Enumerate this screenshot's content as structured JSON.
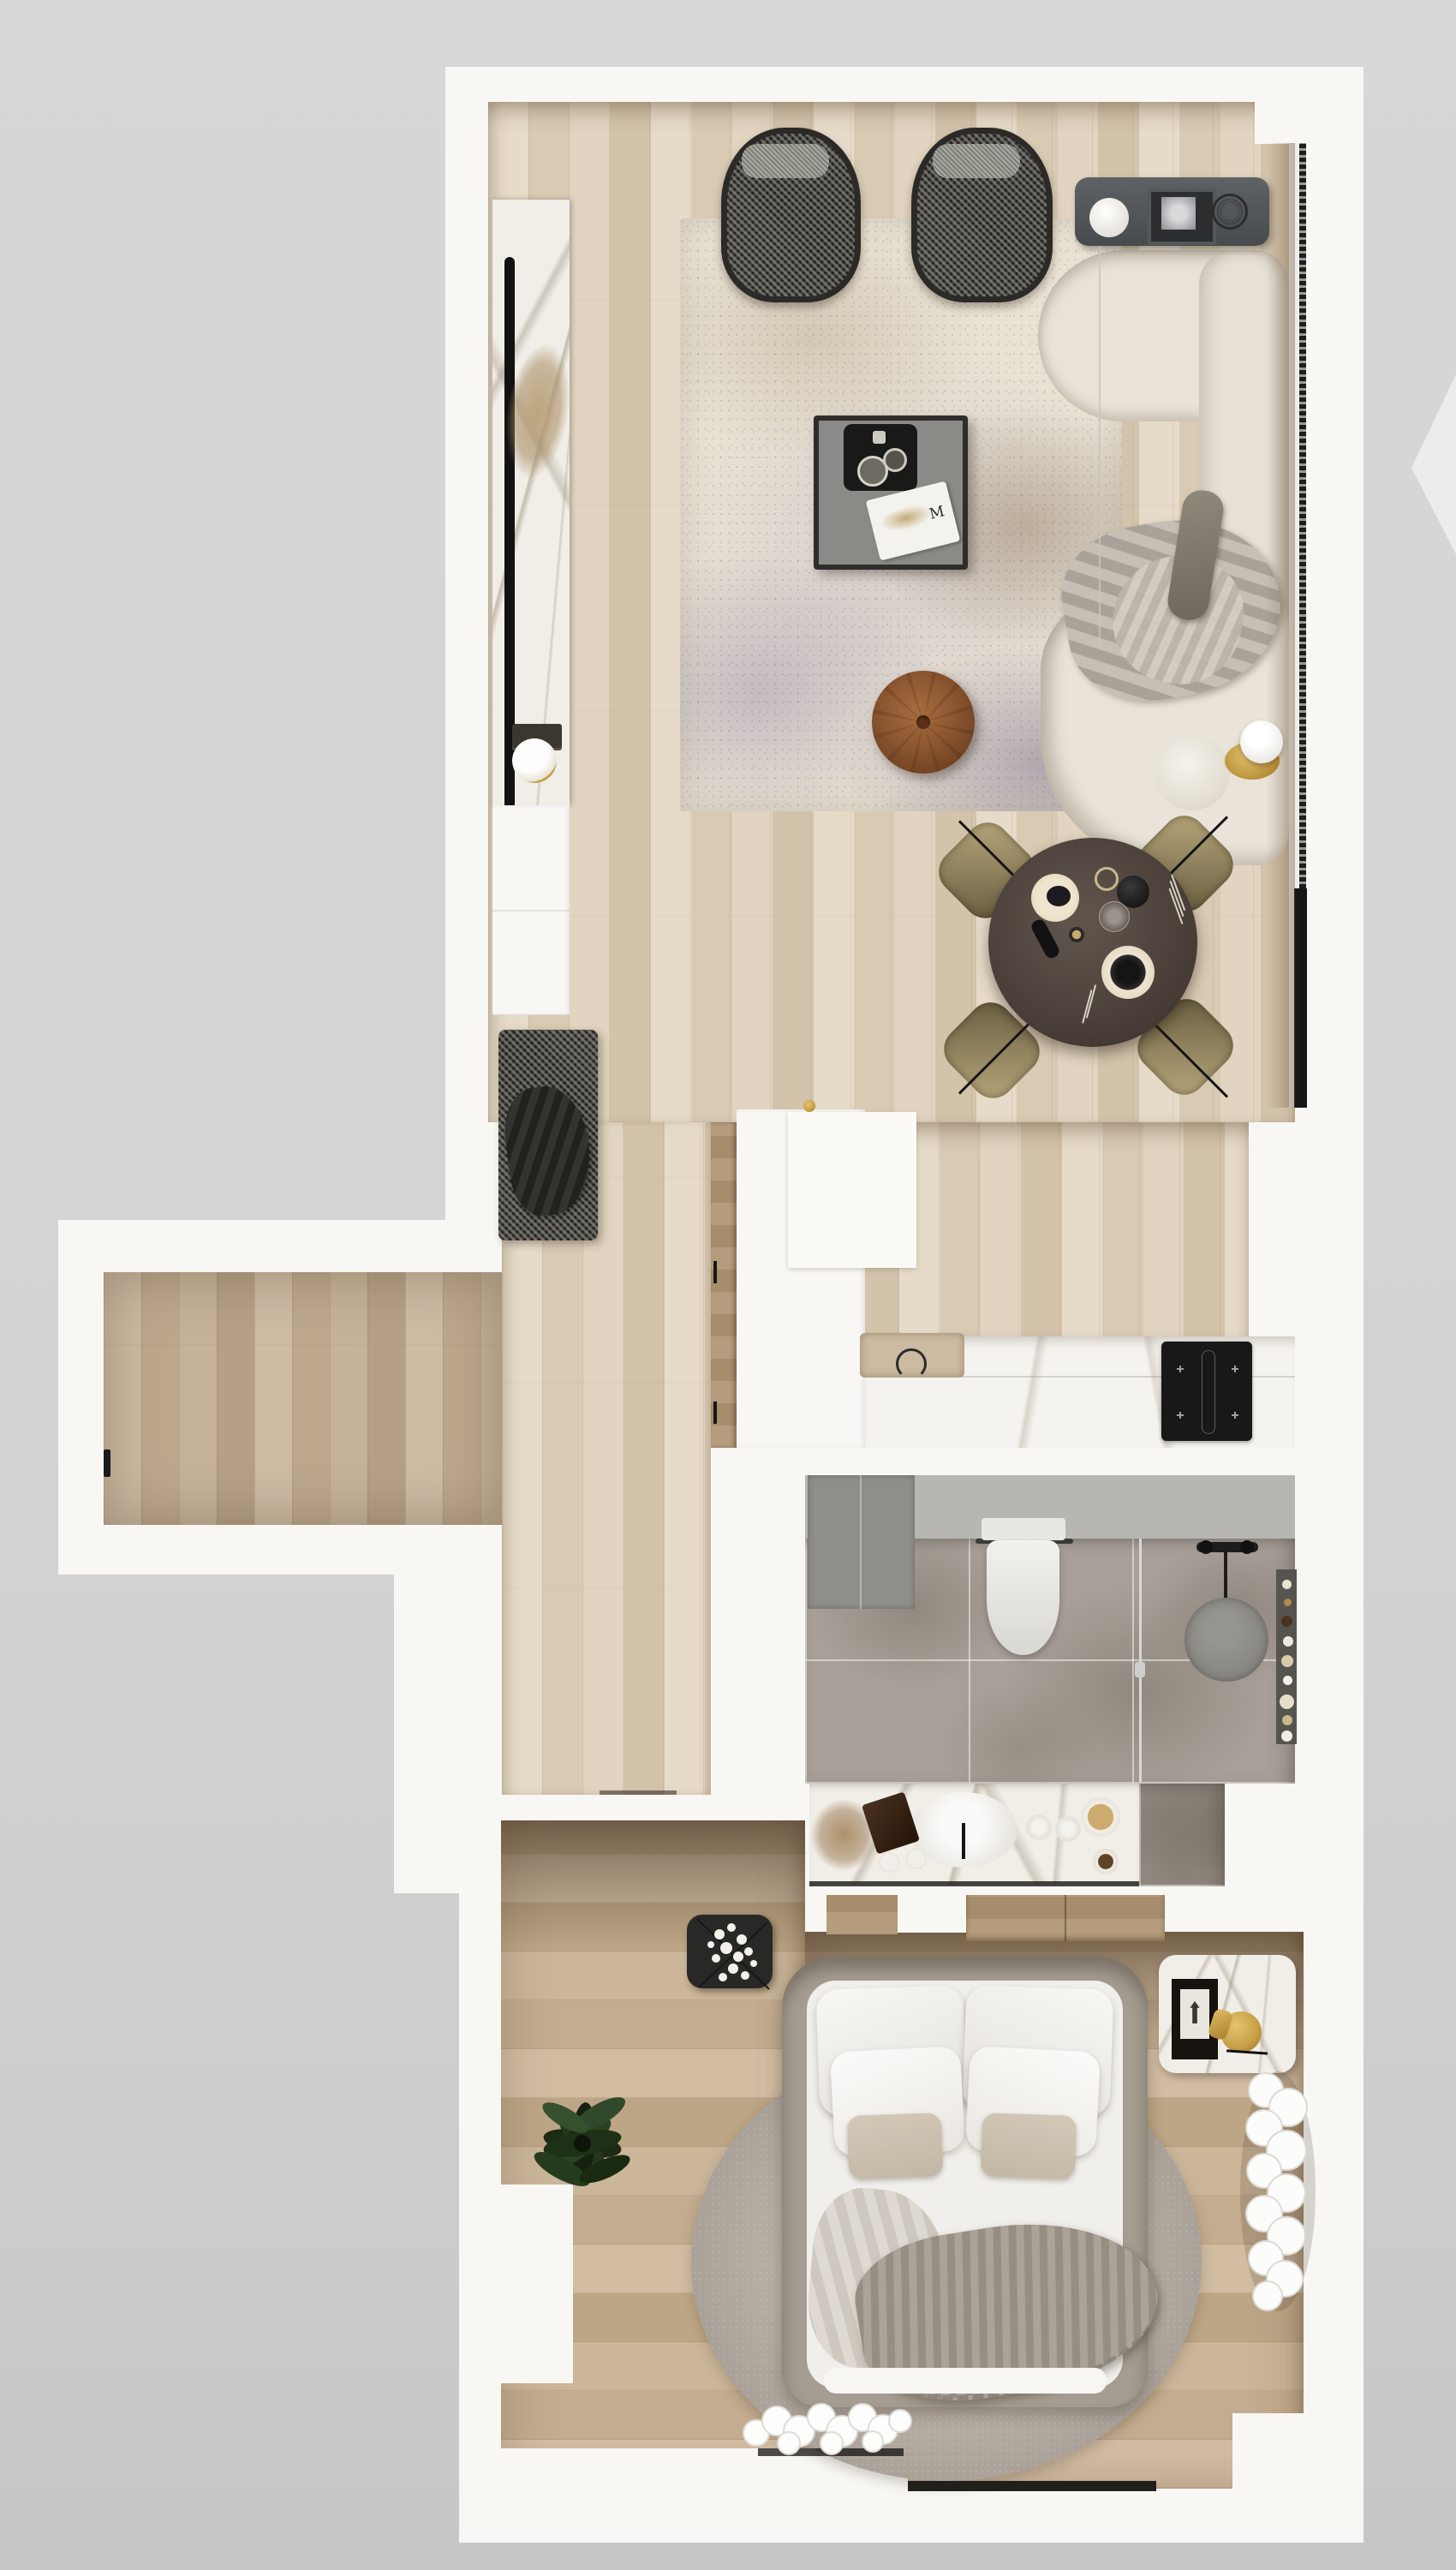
{
  "scene": {
    "label": "apartment-floor-plan-top-view",
    "style": "photoreal-render"
  },
  "palette": {
    "background": "#d3d3d3",
    "wall": "#f8f7f4",
    "wood_living": "#dccdb9",
    "wood_hall": "#c2b098",
    "wood_bedroom": "#c8b296",
    "bath_tile": "#a8a098",
    "marble": "#f1eee8",
    "sofa": "#e8e2d8",
    "chair_dark": "#3c3b35",
    "dining_table": "#4c423a",
    "dining_chair": "#8d7c58",
    "pouf_leather": "#8a5530",
    "accent_gold": "#c9a24a",
    "rug_living": "#e9e2d4",
    "rug_bedroom": "#b3aaa2",
    "cooktop": "#181818",
    "plant_green": "#24371a"
  },
  "living": {
    "label": "living-room",
    "magazine_text": "M",
    "items": [
      "tv-marble-panel",
      "tv",
      "media-cabinet",
      "bench",
      "armchair-left",
      "armchair-right",
      "area-rug",
      "coffee-table",
      "magazine",
      "pouf",
      "sofa",
      "throw-blanket",
      "console-shelf",
      "table-lamp",
      "framed-art",
      "wire-sculpture",
      "floor-lamp",
      "curtain-track"
    ]
  },
  "dining": {
    "label": "dining-area",
    "items": [
      "round-table",
      "chair-nw",
      "chair-ne",
      "chair-sw",
      "chair-se",
      "tableware"
    ]
  },
  "kitchen": {
    "label": "kitchen",
    "items": [
      "tall-cabinet",
      "pantry",
      "counter",
      "sink",
      "faucet",
      "cooktop"
    ]
  },
  "hallway": {
    "label": "entry-hall",
    "items": [
      "entry-door-handle"
    ]
  },
  "bathroom": {
    "label": "bathroom",
    "items": [
      "storage-cabinet",
      "toilet",
      "towel-rail",
      "shower-glass",
      "shower-set",
      "floor-drain",
      "shelf",
      "vanity",
      "basin",
      "decor"
    ]
  },
  "bedroom": {
    "label": "bedroom",
    "items": [
      "wardrobe",
      "double-bed",
      "pillows",
      "duvet",
      "knit-blanket",
      "round-rug",
      "plant",
      "flower-side-table",
      "marble-nightstand",
      "fur-bench",
      "fur-slippers"
    ]
  }
}
